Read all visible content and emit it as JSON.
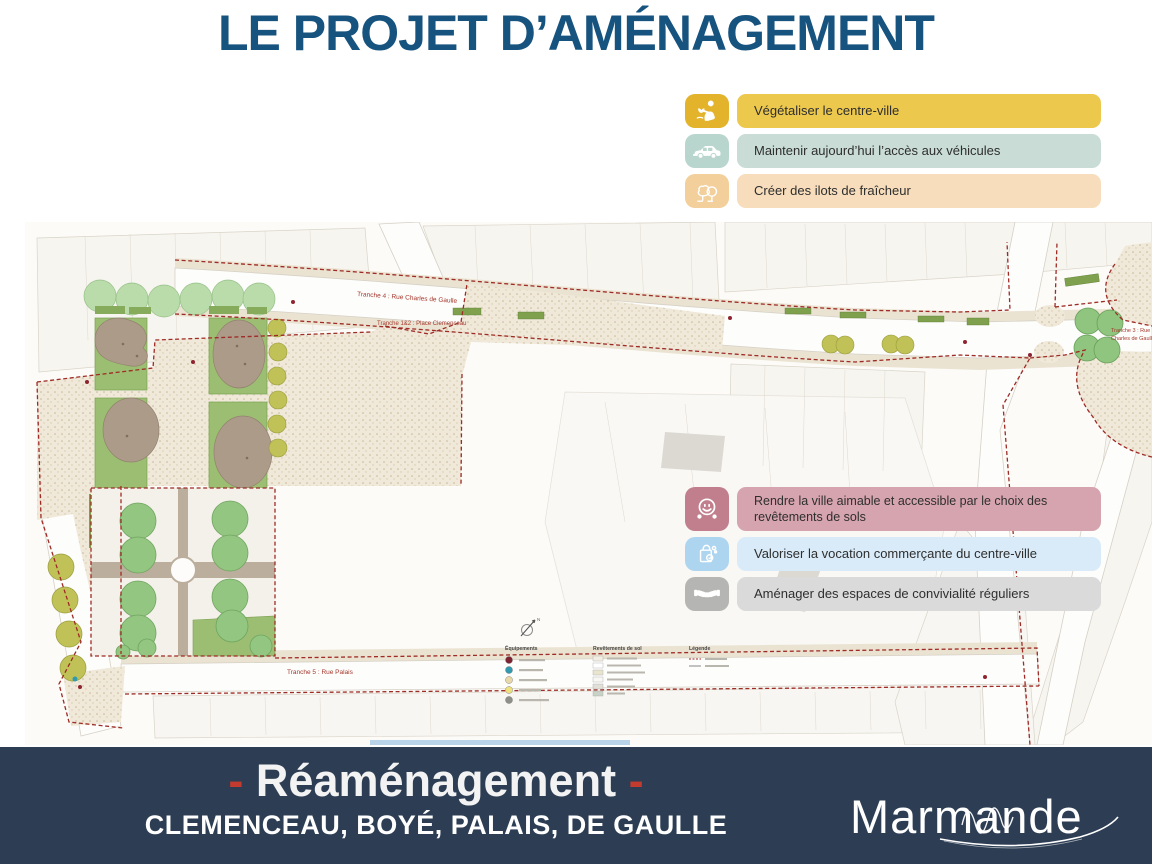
{
  "page": {
    "title": "LE PROJET D’AMÉNAGEMENT"
  },
  "colors": {
    "title_blue": "#17537f",
    "footer_bg": "#2d3e54",
    "accent_red": "#c23b2e",
    "boundary_red": "#9e2b25",
    "map_label_red": "#a5382b"
  },
  "callouts_top": [
    {
      "icon": "planting-person-icon",
      "label": "Végétaliser le centre-ville",
      "banner_color": "#ecc84d",
      "icon_color": "#e2b32b"
    },
    {
      "icon": "car-icon",
      "label": "Maintenir aujourd’hui l’accès aux véhicules",
      "banner_color": "#c9dcd6",
      "icon_color": "#b9d6ce"
    },
    {
      "icon": "trees-icon",
      "label": "Créer des ilots de fraîcheur",
      "banner_color": "#f7ddbb",
      "icon_color": "#f2cf9b"
    }
  ],
  "callouts_mid": [
    {
      "icon": "smiley-icon",
      "label": "Rendre la ville aimable et accessible par le choix des revêtements de sols",
      "banner_color": "#d6a4af",
      "icon_color": "#c17f8d"
    },
    {
      "icon": "shopping-bag-icon",
      "label": "Valoriser la vocation commerçante du centre-ville",
      "banner_color": "#d9ebf8",
      "icon_color": "#aed5f0"
    },
    {
      "icon": "handshake-icon",
      "label": "Aménager des espaces de convivialité réguliers",
      "banner_color": "#dadada",
      "icon_color": "#b5b5b3"
    }
  ],
  "map": {
    "labels": {
      "tranche4": "Tranche 4 : Rue Charles de Gaulle",
      "tranche12": "Tranche 1&2 : Place Clemenceau",
      "tranche5": "Tranche 5 : Rue Palais",
      "tranche3_line1": "Tranche 3 : Rue",
      "tranche3_line2": "Charles de Gaulle"
    },
    "legend": {
      "col1": "Équipements",
      "col2": "Revêtements de sol",
      "col3": "Légende",
      "north": "N"
    }
  },
  "footer": {
    "line1_prefix": "-",
    "line1_text": "Réaménagement",
    "line1_suffix": "-",
    "line2": "CLEMENCEAU, BOYÉ, PALAIS, DE GAULLE",
    "logo": "Marmande"
  }
}
